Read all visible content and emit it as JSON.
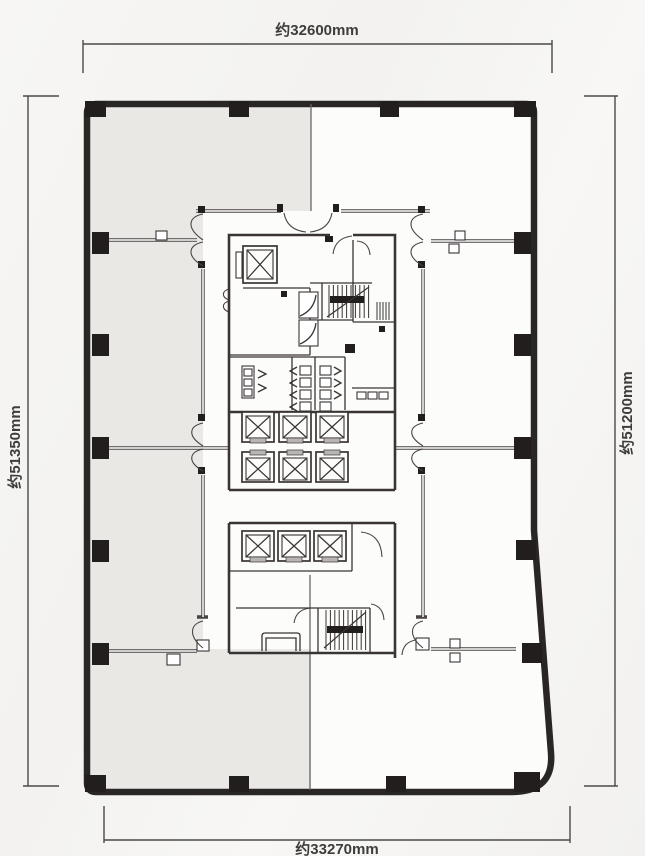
{
  "page": {
    "background_color": "#f6f5f3",
    "type": "architectural floor plan"
  },
  "plan": {
    "dimension_labels": {
      "top": "约32600mm",
      "bottom": "约33270mm",
      "left": "约51350mm",
      "right": "约51200mm"
    },
    "colors": {
      "background": "#f6f5f3",
      "interior": "#fcfcfb",
      "shaded_area": "#e9e8e5",
      "wall": "#2b2626",
      "partition_line": "#4a4444",
      "core_line": "#3a3434",
      "column": "#231e1e",
      "elevator_door": "#b8b5b2",
      "text": "#3d3d3d"
    },
    "features": {
      "passenger_elevator_shafts": 9,
      "service_elevator_shafts": 1,
      "stairwells": 2,
      "perimeter_columns": 18,
      "shaded_zone": "left tenant area"
    }
  }
}
